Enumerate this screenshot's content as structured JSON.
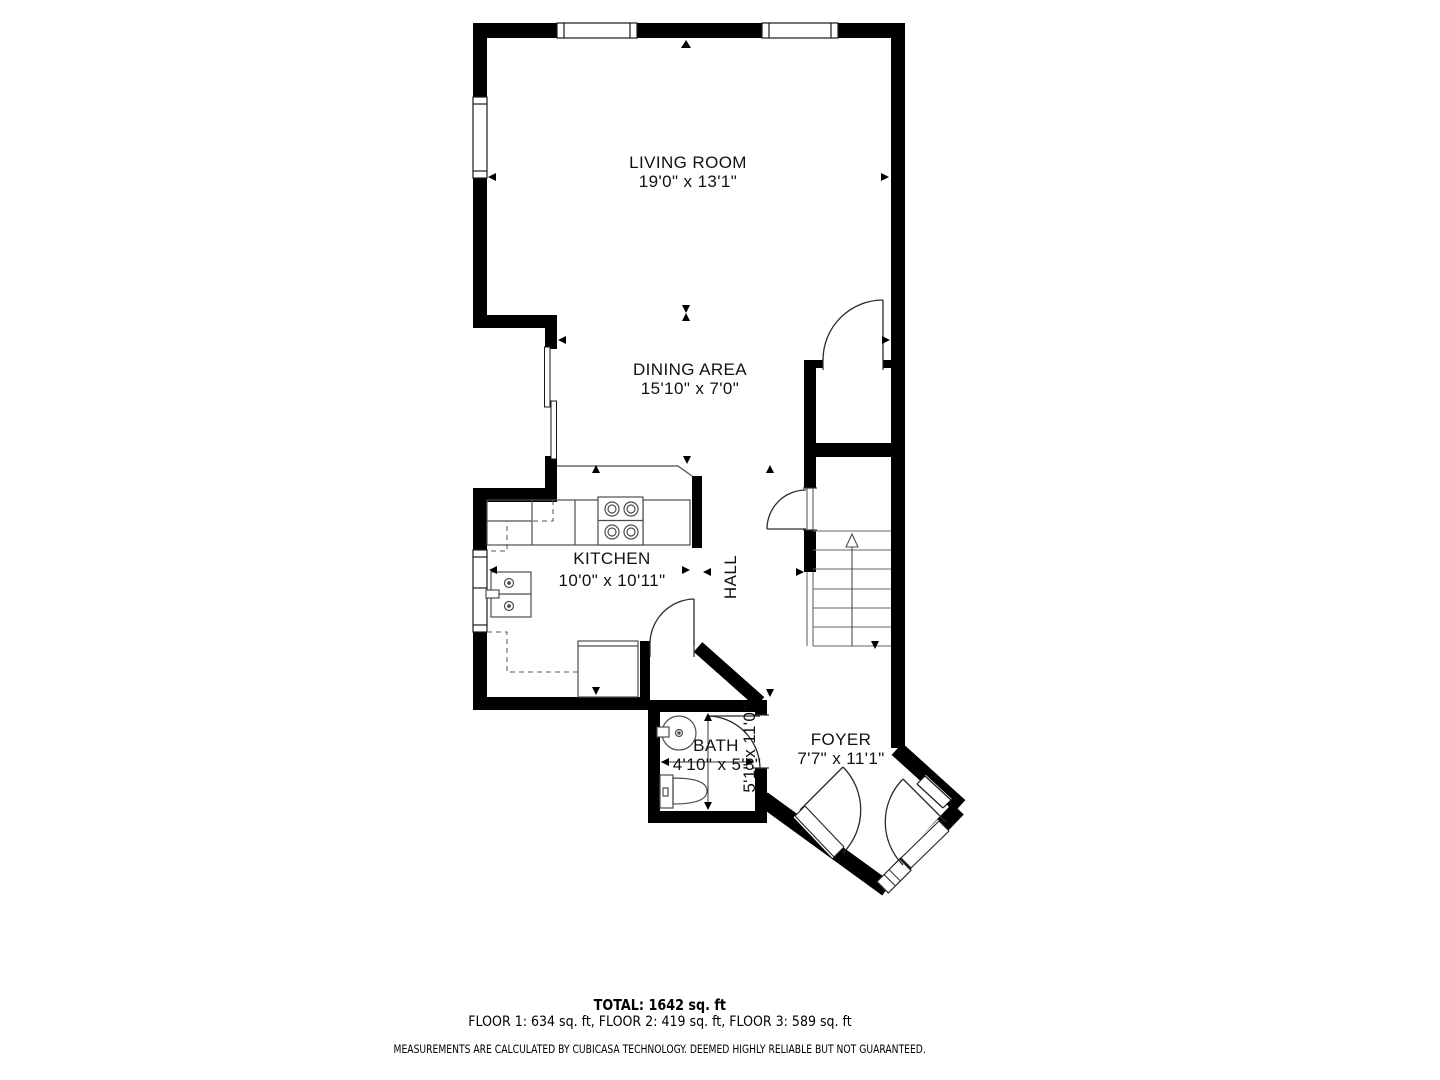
{
  "plan": {
    "rooms": {
      "living_room": {
        "name": "LIVING ROOM",
        "dims": "19'0\" x 13'1\""
      },
      "dining_area": {
        "name": "DINING AREA",
        "dims": "15'10\" x 7'0\""
      },
      "kitchen": {
        "name": "KITCHEN",
        "dims": "10'0\" x 10'11\""
      },
      "hall": {
        "name": "HALL",
        "dims": "5'1\" x 11'0\""
      },
      "bath": {
        "name": "BATH",
        "dims": "4'10\" x 5'3\""
      },
      "foyer": {
        "name": "FOYER",
        "dims": "7'7\" x 11'1\""
      }
    },
    "fixtures": [
      "stove",
      "kitchen-sink",
      "dishwasher-counter",
      "bathroom-sink",
      "toilet",
      "staircase",
      "sliding-door"
    ],
    "colors": {
      "wall": "#000000",
      "background": "#ffffff",
      "fixture_line": "#4d4d4d"
    }
  },
  "summary": {
    "total": "TOTAL: 1642 sq. ft",
    "floors": "FLOOR 1: 634 sq. ft, FLOOR 2: 419 sq. ft, FLOOR 3: 589 sq. ft",
    "disclaimer": "MEASUREMENTS ARE CALCULATED BY CUBICASA TECHNOLOGY. DEEMED HIGHLY RELIABLE BUT NOT GUARANTEED."
  }
}
